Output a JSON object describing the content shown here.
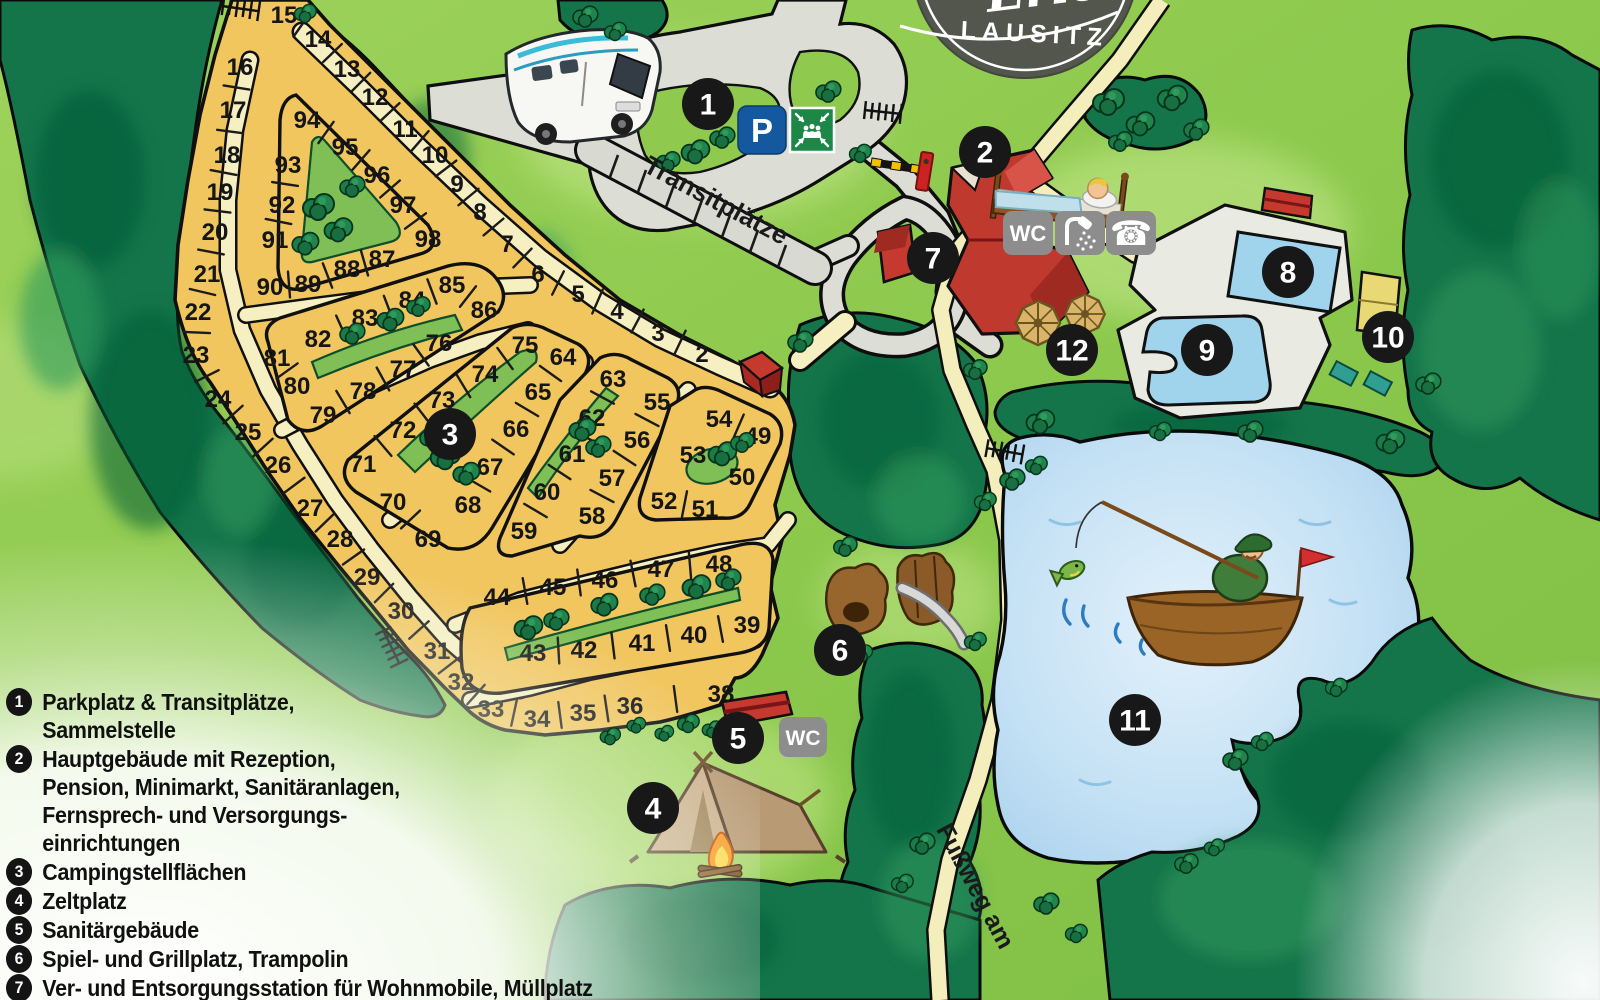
{
  "logo": {
    "script_text": "Erlebni",
    "region_text": "LAUSITZ"
  },
  "labels": {
    "transit": "Transitplätze",
    "footpath": "Fußweg am"
  },
  "icons": {
    "parking_label": "P",
    "assembly_name": "assembly-point-sign",
    "wc_main_label": "WC",
    "shower_name": "shower-sign",
    "phone_name": "phone-sign",
    "wc_sanitary_label": "WC"
  },
  "legend": {
    "items": [
      {
        "num": "1",
        "lines": [
          "Parkplatz & Transitplätze,",
          "Sammelstelle"
        ]
      },
      {
        "num": "2",
        "lines": [
          "Hauptgebäude mit Rezeption,",
          "Pension, Minimarkt, Sanitäranlagen,",
          "Fernsprech- und Versorgungs-",
          "einrichtungen"
        ]
      },
      {
        "num": "3",
        "lines": [
          "Campingstellflächen"
        ]
      },
      {
        "num": "4",
        "lines": [
          "Zeltplatz"
        ]
      },
      {
        "num": "5",
        "lines": [
          "Sanitärgebäude"
        ]
      },
      {
        "num": "6",
        "lines": [
          "Spiel- und Grillplatz, Trampolin"
        ]
      },
      {
        "num": "7",
        "lines": [
          "Ver- und Entsorgungsstation für Wohnmobile, Müllplatz"
        ]
      }
    ]
  },
  "map": {
    "markers": [
      {
        "n": "1",
        "x": 708,
        "y": 104
      },
      {
        "n": "2",
        "x": 985,
        "y": 152
      },
      {
        "n": "3",
        "x": 450,
        "y": 434
      },
      {
        "n": "4",
        "x": 653,
        "y": 808
      },
      {
        "n": "5",
        "x": 738,
        "y": 738
      },
      {
        "n": "6",
        "x": 840,
        "y": 650
      },
      {
        "n": "7",
        "x": 933,
        "y": 258
      },
      {
        "n": "8",
        "x": 1288,
        "y": 272
      },
      {
        "n": "9",
        "x": 1207,
        "y": 350
      },
      {
        "n": "10",
        "x": 1388,
        "y": 337
      },
      {
        "n": "11",
        "x": 1135,
        "y": 720
      },
      {
        "n": "12",
        "x": 1072,
        "y": 350
      }
    ],
    "plots": [
      {
        "n": "15",
        "x": 284,
        "y": 14
      },
      {
        "n": "14",
        "x": 318,
        "y": 38
      },
      {
        "n": "13",
        "x": 347,
        "y": 68
      },
      {
        "n": "12",
        "x": 375,
        "y": 96
      },
      {
        "n": "11",
        "x": 405,
        "y": 128
      },
      {
        "n": "10",
        "x": 435,
        "y": 154
      },
      {
        "n": "9",
        "x": 457,
        "y": 183
      },
      {
        "n": "8",
        "x": 480,
        "y": 211
      },
      {
        "n": "7",
        "x": 507,
        "y": 243
      },
      {
        "n": "6",
        "x": 538,
        "y": 273
      },
      {
        "n": "5",
        "x": 578,
        "y": 293
      },
      {
        "n": "4",
        "x": 617,
        "y": 310
      },
      {
        "n": "3",
        "x": 658,
        "y": 332
      },
      {
        "n": "2",
        "x": 702,
        "y": 353
      },
      {
        "n": "16",
        "x": 240,
        "y": 66
      },
      {
        "n": "17",
        "x": 233,
        "y": 109
      },
      {
        "n": "18",
        "x": 227,
        "y": 154
      },
      {
        "n": "19",
        "x": 220,
        "y": 191
      },
      {
        "n": "20",
        "x": 215,
        "y": 231
      },
      {
        "n": "21",
        "x": 207,
        "y": 273
      },
      {
        "n": "22",
        "x": 198,
        "y": 311
      },
      {
        "n": "23",
        "x": 196,
        "y": 354
      },
      {
        "n": "24",
        "x": 218,
        "y": 398
      },
      {
        "n": "25",
        "x": 248,
        "y": 431
      },
      {
        "n": "26",
        "x": 278,
        "y": 464
      },
      {
        "n": "27",
        "x": 310,
        "y": 507
      },
      {
        "n": "28",
        "x": 340,
        "y": 538
      },
      {
        "n": "29",
        "x": 367,
        "y": 576
      },
      {
        "n": "30",
        "x": 401,
        "y": 610
      },
      {
        "n": "31",
        "x": 437,
        "y": 650
      },
      {
        "n": "32",
        "x": 461,
        "y": 681
      },
      {
        "n": "33",
        "x": 491,
        "y": 708
      },
      {
        "n": "34",
        "x": 537,
        "y": 718
      },
      {
        "n": "35",
        "x": 583,
        "y": 712
      },
      {
        "n": "36",
        "x": 630,
        "y": 705
      },
      {
        "n": "38",
        "x": 721,
        "y": 693
      },
      {
        "n": "94",
        "x": 307,
        "y": 119
      },
      {
        "n": "95",
        "x": 345,
        "y": 146
      },
      {
        "n": "96",
        "x": 377,
        "y": 174
      },
      {
        "n": "97",
        "x": 403,
        "y": 204
      },
      {
        "n": "98",
        "x": 428,
        "y": 238
      },
      {
        "n": "93",
        "x": 288,
        "y": 164
      },
      {
        "n": "92",
        "x": 282,
        "y": 204
      },
      {
        "n": "91",
        "x": 275,
        "y": 239
      },
      {
        "n": "90",
        "x": 270,
        "y": 286
      },
      {
        "n": "89",
        "x": 308,
        "y": 283
      },
      {
        "n": "88",
        "x": 347,
        "y": 268
      },
      {
        "n": "87",
        "x": 382,
        "y": 258
      },
      {
        "n": "81",
        "x": 277,
        "y": 357
      },
      {
        "n": "82",
        "x": 318,
        "y": 338
      },
      {
        "n": "83",
        "x": 365,
        "y": 317
      },
      {
        "n": "84",
        "x": 412,
        "y": 299
      },
      {
        "n": "85",
        "x": 452,
        "y": 284
      },
      {
        "n": "86",
        "x": 484,
        "y": 309
      },
      {
        "n": "76",
        "x": 439,
        "y": 342
      },
      {
        "n": "77",
        "x": 403,
        "y": 368
      },
      {
        "n": "78",
        "x": 363,
        "y": 390
      },
      {
        "n": "79",
        "x": 323,
        "y": 414
      },
      {
        "n": "80",
        "x": 297,
        "y": 385
      },
      {
        "n": "75",
        "x": 525,
        "y": 344
      },
      {
        "n": "64",
        "x": 563,
        "y": 356
      },
      {
        "n": "74",
        "x": 485,
        "y": 373
      },
      {
        "n": "65",
        "x": 538,
        "y": 391
      },
      {
        "n": "73",
        "x": 442,
        "y": 399
      },
      {
        "n": "66",
        "x": 516,
        "y": 428
      },
      {
        "n": "72",
        "x": 403,
        "y": 429
      },
      {
        "n": "67",
        "x": 490,
        "y": 466
      },
      {
        "n": "71",
        "x": 363,
        "y": 463
      },
      {
        "n": "68",
        "x": 468,
        "y": 504
      },
      {
        "n": "70",
        "x": 393,
        "y": 501
      },
      {
        "n": "69",
        "x": 428,
        "y": 538
      },
      {
        "n": "63",
        "x": 613,
        "y": 378
      },
      {
        "n": "62",
        "x": 592,
        "y": 417
      },
      {
        "n": "61",
        "x": 572,
        "y": 453
      },
      {
        "n": "60",
        "x": 547,
        "y": 491
      },
      {
        "n": "59",
        "x": 524,
        "y": 530
      },
      {
        "n": "58",
        "x": 592,
        "y": 515
      },
      {
        "n": "57",
        "x": 612,
        "y": 477
      },
      {
        "n": "56",
        "x": 637,
        "y": 439
      },
      {
        "n": "55",
        "x": 657,
        "y": 401
      },
      {
        "n": "54",
        "x": 719,
        "y": 418
      },
      {
        "n": "49",
        "x": 758,
        "y": 435
      },
      {
        "n": "53",
        "x": 693,
        "y": 454
      },
      {
        "n": "50",
        "x": 742,
        "y": 476
      },
      {
        "n": "52",
        "x": 664,
        "y": 500
      },
      {
        "n": "51",
        "x": 705,
        "y": 508
      },
      {
        "n": "44",
        "x": 497,
        "y": 596
      },
      {
        "n": "45",
        "x": 553,
        "y": 586
      },
      {
        "n": "46",
        "x": 605,
        "y": 579
      },
      {
        "n": "47",
        "x": 661,
        "y": 568
      },
      {
        "n": "48",
        "x": 719,
        "y": 563
      },
      {
        "n": "43",
        "x": 533,
        "y": 652
      },
      {
        "n": "42",
        "x": 584,
        "y": 649
      },
      {
        "n": "41",
        "x": 642,
        "y": 642
      },
      {
        "n": "40",
        "x": 694,
        "y": 634
      },
      {
        "n": "39",
        "x": 747,
        "y": 624
      }
    ],
    "divider_chains": [
      [
        "15",
        "14",
        "13",
        "12",
        "11",
        "10",
        "9",
        "8",
        "7",
        "6",
        "5",
        "4",
        "3",
        "2"
      ],
      [
        "16",
        "17",
        "18",
        "19",
        "20",
        "21",
        "22",
        "23",
        "24",
        "25",
        "26",
        "27",
        "28",
        "29",
        "30",
        "31",
        "32",
        "33",
        "34",
        "35",
        "36",
        "38"
      ],
      [
        "94",
        "95",
        "96",
        "97",
        "98"
      ],
      [
        "93",
        "92",
        "91"
      ],
      [
        "90",
        "89",
        "88",
        "87"
      ],
      [
        "82",
        "83",
        "84",
        "85",
        "86"
      ],
      [
        "81",
        "80"
      ],
      [
        "79",
        "78",
        "77",
        "76"
      ],
      [
        "75",
        "74",
        "73",
        "72",
        "71"
      ],
      [
        "70",
        "69"
      ],
      [
        "64",
        "65",
        "66",
        "67",
        "68"
      ],
      [
        "63",
        "62",
        "61",
        "60",
        "59"
      ],
      [
        "58",
        "57",
        "56",
        "55"
      ],
      [
        "54",
        "49"
      ],
      [
        "52",
        "51"
      ],
      [
        "44",
        "45",
        "46",
        "47",
        "48"
      ],
      [
        "43",
        "42",
        "41",
        "40",
        "39"
      ]
    ],
    "trees": [
      [
        318,
        205,
        1
      ],
      [
        338,
        228,
        0.9
      ],
      [
        305,
        242,
        0.85
      ],
      [
        352,
        185,
        0.8
      ],
      [
        352,
        332,
        0.8
      ],
      [
        390,
        318,
        0.85
      ],
      [
        418,
        305,
        0.75
      ],
      [
        445,
        455,
        0.95
      ],
      [
        466,
        472,
        0.85
      ],
      [
        432,
        436,
        0.8
      ],
      [
        582,
        428,
        0.85
      ],
      [
        598,
        445,
        0.8
      ],
      [
        722,
        452,
        0.9
      ],
      [
        742,
        441,
        0.75
      ],
      [
        528,
        626,
        0.9
      ],
      [
        556,
        618,
        0.8
      ],
      [
        604,
        603,
        0.85
      ],
      [
        652,
        593,
        0.8
      ],
      [
        696,
        585,
        0.9
      ],
      [
        728,
        578,
        0.8
      ],
      [
        695,
        150,
        0.9
      ],
      [
        722,
        136,
        0.8
      ],
      [
        668,
        160,
        0.75
      ],
      [
        828,
        90,
        0.8
      ],
      [
        688,
        722,
        0.7
      ],
      [
        712,
        728,
        0.65
      ],
      [
        664,
        732,
        0.6
      ],
      [
        610,
        735,
        0.65
      ],
      [
        636,
        724,
        0.6
      ],
      [
        860,
        152,
        0.7
      ],
      [
        1108,
        100,
        1
      ],
      [
        1140,
        122,
        0.9
      ],
      [
        1172,
        96,
        0.95
      ],
      [
        1196,
        128,
        0.8
      ],
      [
        1120,
        140,
        0.75
      ],
      [
        1040,
        420,
        0.9
      ],
      [
        1250,
        430,
        0.8
      ],
      [
        1390,
        440,
        0.9
      ],
      [
        1160,
        430,
        0.7
      ],
      [
        1012,
        478,
        0.8
      ],
      [
        1036,
        464,
        0.7
      ],
      [
        1235,
        758,
        0.8
      ],
      [
        1262,
        740,
        0.7
      ],
      [
        1186,
        862,
        0.75
      ],
      [
        1214,
        846,
        0.65
      ],
      [
        1336,
        686,
        0.7
      ],
      [
        922,
        842,
        0.8
      ],
      [
        902,
        882,
        0.7
      ],
      [
        1046,
        902,
        0.8
      ],
      [
        1076,
        932,
        0.7
      ],
      [
        1428,
        382,
        0.8
      ],
      [
        585,
        15,
        0.8
      ],
      [
        615,
        30,
        0.7
      ],
      [
        305,
        12,
        0.7
      ],
      [
        800,
        340,
        0.8
      ],
      [
        975,
        368,
        0.75
      ],
      [
        985,
        500,
        0.7
      ],
      [
        845,
        545,
        0.75
      ],
      [
        975,
        640,
        0.7
      ],
      [
        862,
        652,
        0.65
      ]
    ]
  },
  "colors": {
    "forest": "#14754a",
    "clearing": "#8fca4e",
    "plot_yellow": "#f1c65f",
    "road_gray": "#dcddd5",
    "path_cream": "#f6efc2",
    "lake_blue": "#bcdcf2",
    "marker_black": "#181818",
    "building_red": "#c5392f",
    "parking_blue": "#14589f",
    "assembly_green": "#1c8746",
    "icon_gray": "#8d8d8d"
  }
}
